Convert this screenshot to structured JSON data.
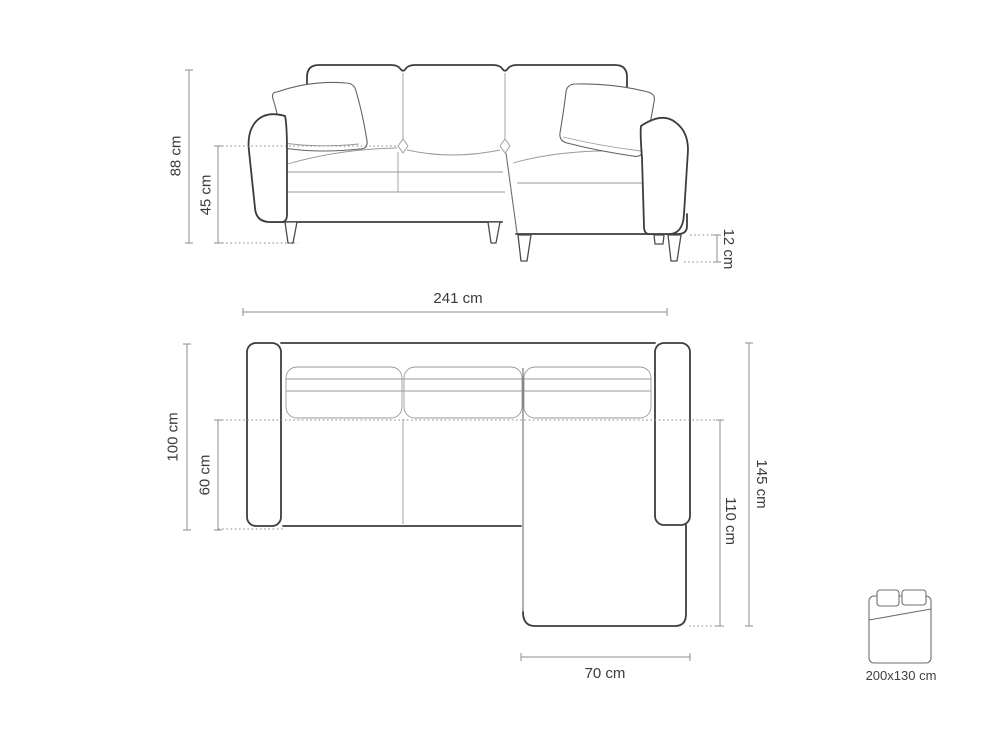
{
  "colors": {
    "background": "#ffffff",
    "outline_bold": "#3c3c3c",
    "outline_detail": "#9a9a9a",
    "dimension_line": "#8c8c8c",
    "label_text": "#3a3a3a"
  },
  "front_view": {
    "dimensions": {
      "total_height": "88 cm",
      "seat_height": "45 cm",
      "leg_height": "12 cm"
    }
  },
  "top_view": {
    "dimensions": {
      "total_width": "241 cm",
      "side_depth": "100 cm",
      "seat_depth": "60 cm",
      "total_depth": "145 cm",
      "chaise_depth": "110 cm",
      "chaise_width": "70 cm"
    }
  },
  "sleeping_area": {
    "icon": "bed-icon",
    "size_label": "200x130 cm"
  }
}
